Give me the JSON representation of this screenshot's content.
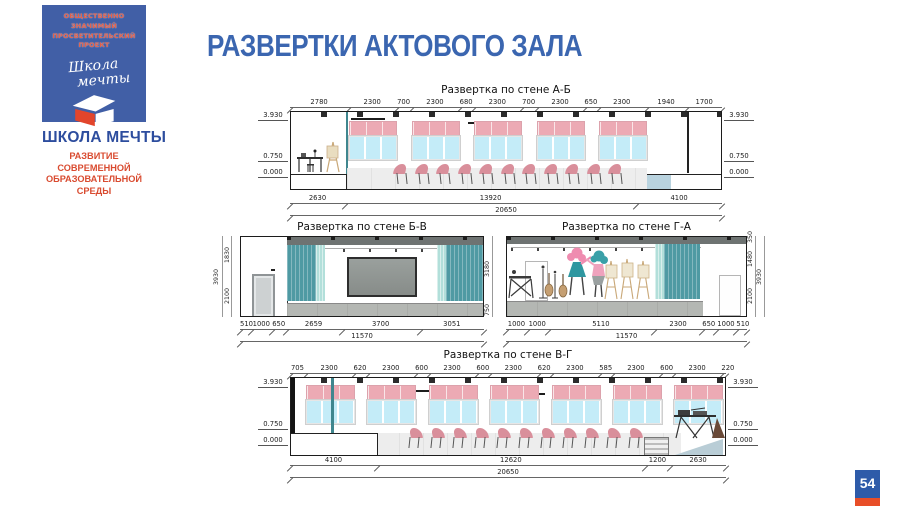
{
  "title": "РАЗВЕРТКИ АКТОВОГО ЗАЛА",
  "page": {
    "number": "54"
  },
  "logo": {
    "badge_line1": "ОБЩЕСТВЕННО ЗНАЧИМЫЙ",
    "badge_line2": "ПРОСВЕТИТЕЛЬСКИЙ ПРОЕКТ",
    "script_word1": "Школа",
    "script_word2": "мечты",
    "name": "ШКОЛА МЕЧТЫ",
    "tagline_line1": "РАЗВИТИЕ СОВРЕМЕННОЙ",
    "tagline_line2": "ОБРАЗОВАТЕЛЬНОЙ СРЕДЫ"
  },
  "colors": {
    "accent_blue": "#3b66b0",
    "accent_red": "#dd4a2d",
    "window_pink": "#ecaab4",
    "window_blue": "#c4ecf8",
    "curtain_teal": "#4f9aa3",
    "stage_gray": "#b4b7b3"
  },
  "elevations": {
    "ab": {
      "title": "Развертка по стене А-Б",
      "top_dims": [
        "2780",
        "2300",
        "700",
        "2300",
        "680",
        "2300",
        "700",
        "2300",
        "650",
        "2300",
        "1940",
        "1700"
      ],
      "levels": [
        "3.930",
        "0.750",
        "0.000"
      ],
      "bottom_dims": [
        "2630",
        "13920",
        "4100"
      ],
      "total": "20650"
    },
    "bv": {
      "title": "Развертка по стене Б-В",
      "left_heights": [
        "1830",
        "2100"
      ],
      "left_total": "3930",
      "right_heights": [
        "3180",
        "750"
      ],
      "bottom_dims": [
        "510",
        "1000",
        "650",
        "2659",
        "3700",
        "3051"
      ],
      "total": "11570"
    },
    "ga": {
      "title": "Развертка по стене Г-А",
      "right_heights": [
        "350",
        "1480",
        "2100"
      ],
      "right_total": "3930",
      "bottom_dims": [
        "1000",
        "1000",
        "5110",
        "2300",
        "650",
        "1000",
        "510"
      ],
      "total": "11570"
    },
    "vg": {
      "title": "Развертка по стене В-Г",
      "top_dims": [
        "705",
        "2300",
        "620",
        "2300",
        "600",
        "2300",
        "600",
        "2300",
        "620",
        "2300",
        "585",
        "2300",
        "600",
        "2300",
        "220"
      ],
      "levels": [
        "3.930",
        "0.750",
        "0.000"
      ],
      "bottom_dims": [
        "4100",
        "12620",
        "1200",
        "2630"
      ],
      "total": "20650"
    }
  }
}
